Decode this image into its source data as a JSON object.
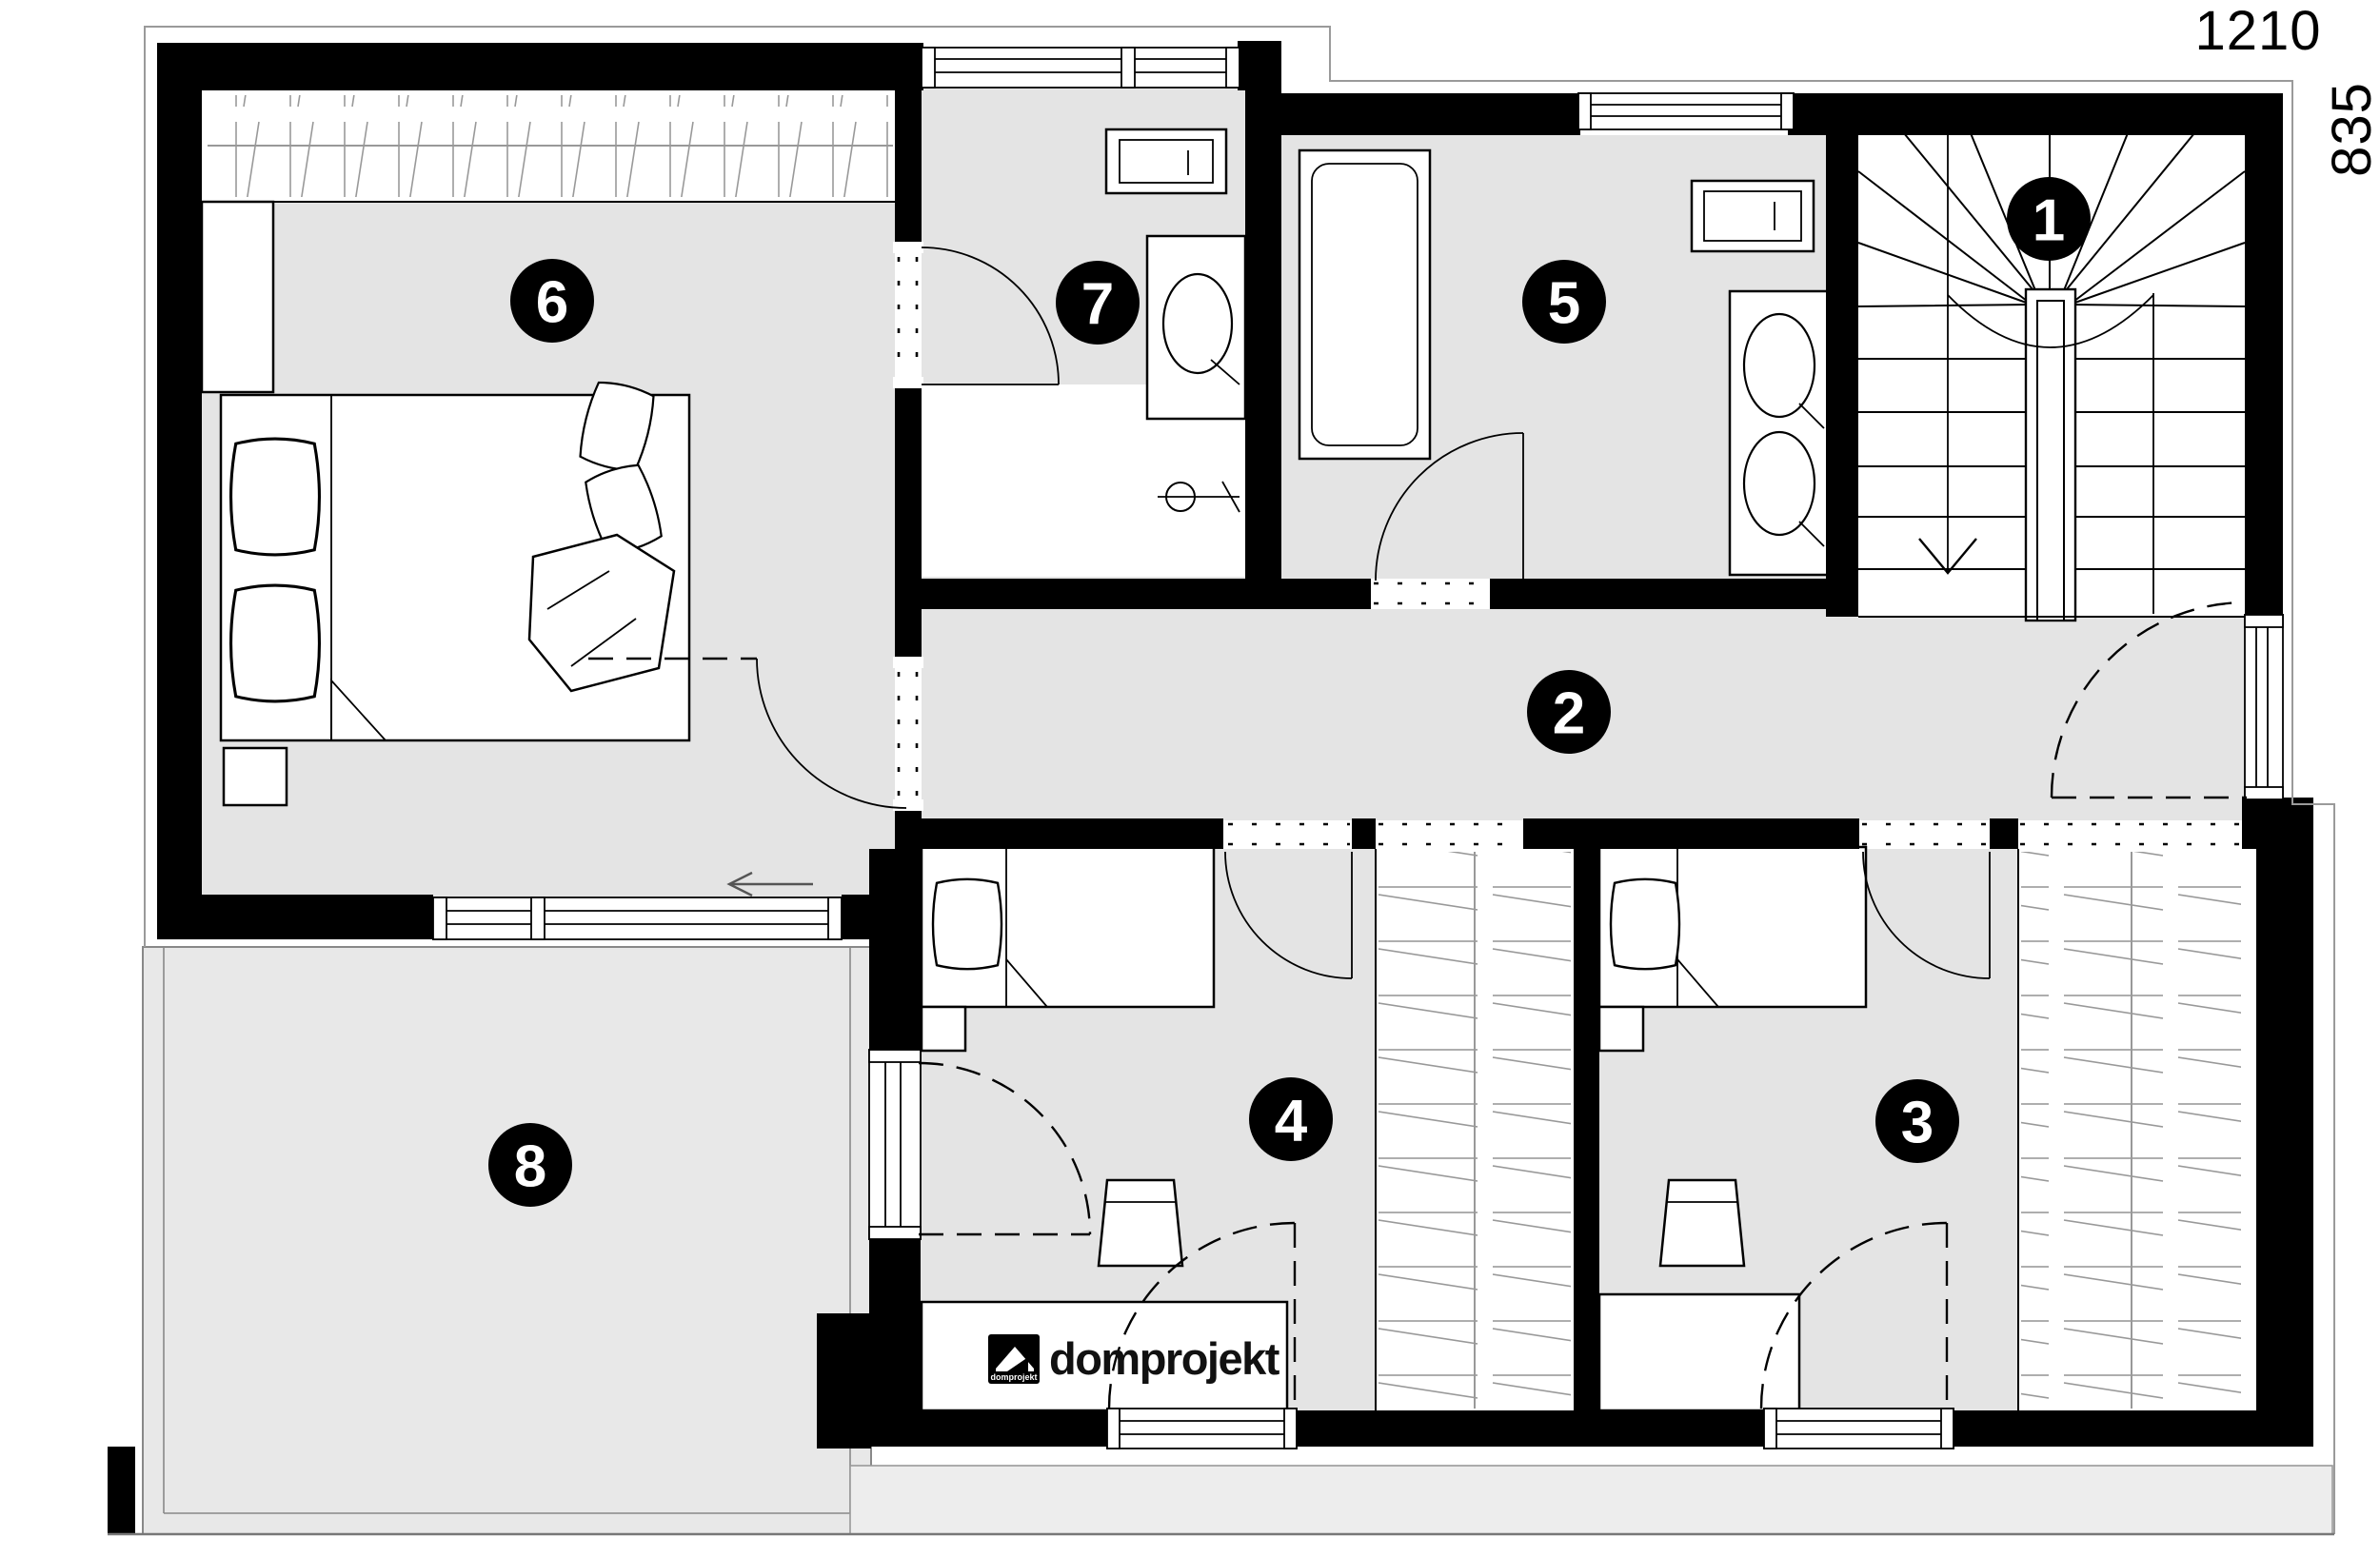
{
  "dimensions": {
    "width_label": "1210",
    "height_label": "835"
  },
  "logo": {
    "name": "domprojekt",
    "icon_text": "domprojekt"
  },
  "rooms": [
    {
      "label": "1"
    },
    {
      "label": "2"
    },
    {
      "label": "3"
    },
    {
      "label": "4"
    },
    {
      "label": "5"
    },
    {
      "label": "6"
    },
    {
      "label": "7"
    },
    {
      "label": "8"
    }
  ],
  "colors": {
    "wall": "#000000",
    "floor": "#e4e4e4",
    "balcony_floor": "#e8e8e8",
    "roof_strip": "#ededed",
    "badge": "#000000",
    "badge_text": "#ffffff",
    "outline": "#9a9a9a"
  }
}
